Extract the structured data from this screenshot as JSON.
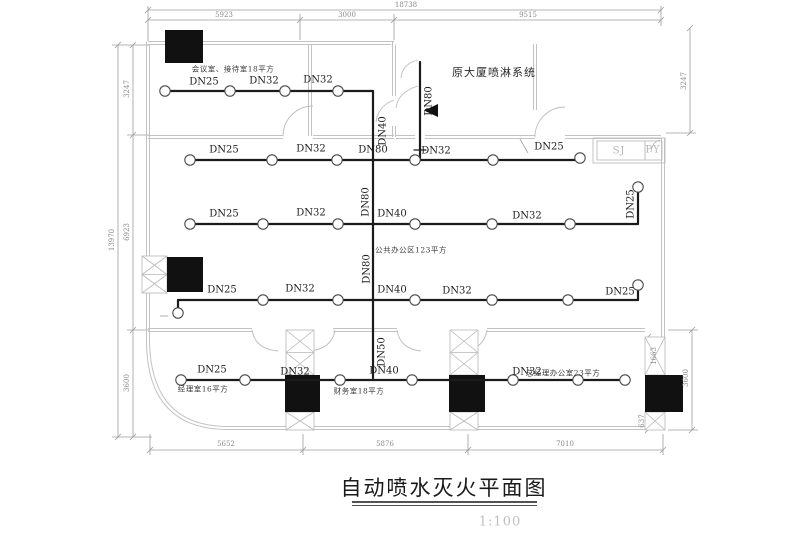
{
  "title": {
    "text": "自动喷水灭火平面图",
    "scale": "1:100"
  },
  "notes": {
    "supply_system": "原大厦喷淋系统",
    "open_office": "公共办公区123平方",
    "room_meeting": "会议室、接待室18平方",
    "room_manager": "经理室16平方",
    "room_finance": "财务室18平方",
    "room_gm": "总经理办公室23平方"
  },
  "shafts": {
    "sj": "SJ",
    "py": "PY"
  },
  "pipes": {
    "row1": [
      "DN25",
      "DN32",
      "DN32"
    ],
    "row2": [
      "DN25",
      "DN32",
      "DN80",
      "DN32",
      "DN25"
    ],
    "row3": [
      "DN25",
      "DN32",
      "DN40",
      "DN32",
      "DN25"
    ],
    "row4": [
      "DN25",
      "DN32",
      "DN40",
      "DN32",
      "DN25"
    ],
    "row5": [
      "DN25",
      "DN32",
      "DN40",
      "DN32"
    ],
    "risers": {
      "supply": "DN80",
      "main_upper": "DN40",
      "main_mid": "DN80",
      "main_lower": "DN80",
      "main_bottom": "DN50"
    }
  },
  "dimensions": {
    "top_total": "18738",
    "top_segments": [
      "5923",
      "3000",
      "9515"
    ],
    "left_total": "13970",
    "left_segments": [
      "3247",
      "6923",
      "3600"
    ],
    "right_upper": "3247",
    "right_lower": "3600",
    "right_inner": [
      "1663",
      "637"
    ],
    "bottom_segments": [
      "5652",
      "5876",
      "7010"
    ]
  }
}
